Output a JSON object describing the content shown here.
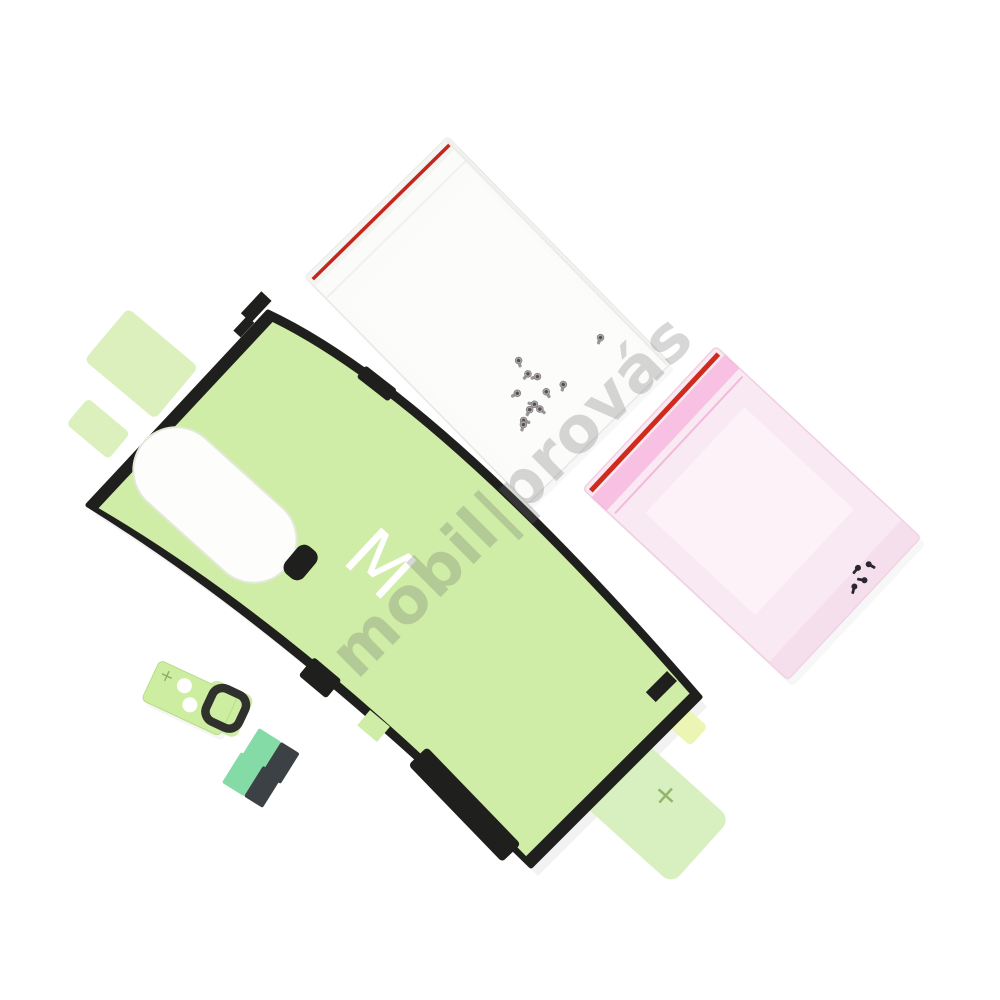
{
  "meta": {
    "description": "Product photo: smartphone back-cover adhesive repair kit with two zip bags of screws, camera lens adhesive and pull-tab pads on a white background",
    "background_color": "#ffffff"
  },
  "watermark": {
    "text": "mobil|provás",
    "color": "rgba(110,110,110,0.28)",
    "rotation_deg": -45
  },
  "adhesive_sheet": {
    "label": "back-cover adhesive sheet",
    "letter": "M",
    "tab_plus_mark": "+",
    "colors": {
      "green": "#cfeda6",
      "border_black": "#1f201d",
      "tab_light_green": "#dcf0bd",
      "tab_big_green": "#d8f0c0",
      "tab_yellow": "#ecf5b4",
      "camera_cutout_white": "#fdfdfc",
      "letter_white": "#ffffff",
      "plus_green": "#96b46c"
    }
  },
  "clear_bag": {
    "label": "clear zip bag with screws",
    "screw_count": 12,
    "colors": {
      "film": "#fbfbf9",
      "edge": "#e8e8e4",
      "zip_line_red": "#c4261d",
      "screw_body": "#a9a9ad",
      "screw_tip": "#5f4c45"
    }
  },
  "pink_bag": {
    "label": "pink zip bag with screws",
    "screw_count": 4,
    "colors": {
      "film": "#f9e9f2",
      "edge": "#f0cfe2",
      "zip_line_red": "#d02a1e",
      "zip_glow_pink": "#f79ad3",
      "screw_black": "#2a2733"
    }
  },
  "camera_adhesive": {
    "label": "camera lens adhesive strip",
    "plus_mark": "+",
    "colors": {
      "green": "#cdeda1",
      "ring_black": "#30302c",
      "dot_white": "#ffffff",
      "plus_green": "#8fae66"
    }
  },
  "adhesive_pads": {
    "label": "adhesive pull-tab pads",
    "count": 2,
    "colors": {
      "mint": "#85dba6",
      "dark": "#3b4144"
    }
  }
}
